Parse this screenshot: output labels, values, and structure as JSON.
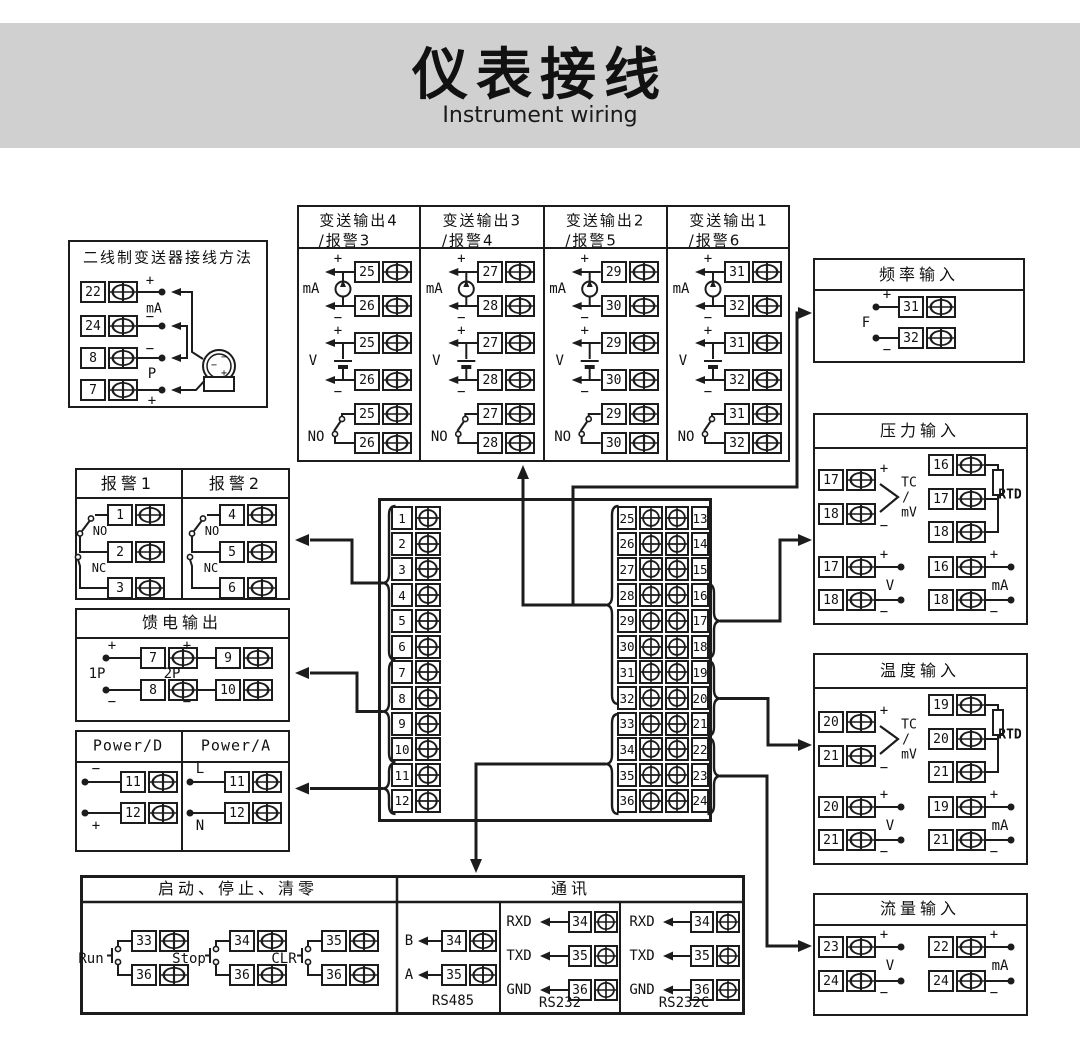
{
  "title": {
    "zh": "仪表接线",
    "en": "Instrument wiring"
  },
  "signs": {
    "plus": "+",
    "minus": "−"
  },
  "two_wire": {
    "title": "二线制变送器接线方法",
    "terminals": [
      "22",
      "24",
      "8",
      "7"
    ],
    "labels": {
      "ma": "mA",
      "p": "P"
    },
    "sensor": {
      "minus1": "−",
      "minus2": "−",
      "plus": "+"
    }
  },
  "transmit": {
    "columns": [
      {
        "title": "变送输出4",
        "subtitle": "/报警3",
        "pair": [
          "25",
          "26"
        ]
      },
      {
        "title": "变送输出3",
        "subtitle": "/报警4",
        "pair": [
          "27",
          "28"
        ]
      },
      {
        "title": "变送输出2",
        "subtitle": "/报警5",
        "pair": [
          "29",
          "30"
        ]
      },
      {
        "title": "变送输出1",
        "subtitle": "/报警6",
        "pair": [
          "31",
          "32"
        ]
      }
    ],
    "labels": {
      "ma": "mA",
      "v": "V",
      "no": "NO"
    }
  },
  "frequency": {
    "title": "频率输入",
    "label": "F",
    "terminals": [
      {
        "n": "31"
      },
      {
        "n": "32"
      }
    ]
  },
  "pressure": {
    "title": "压力输入",
    "tc": {
      "terminals": [
        "17",
        "18"
      ],
      "lines": [
        "TC",
        "/",
        "mV"
      ]
    },
    "rtd": {
      "terminals": [
        "16",
        "17",
        "18"
      ],
      "label": "RTD"
    },
    "v": {
      "terminals": [
        "17",
        "18"
      ],
      "label": "V"
    },
    "ma": {
      "terminals": [
        "16",
        "18"
      ],
      "label": "mA"
    }
  },
  "temperature": {
    "title": "温度输入",
    "tc": {
      "terminals": [
        "20",
        "21"
      ],
      "lines": [
        "TC",
        "/",
        "mV"
      ]
    },
    "rtd": {
      "terminals": [
        "19",
        "20",
        "21"
      ],
      "label": "RTD"
    },
    "v": {
      "terminals": [
        "20",
        "21"
      ],
      "label": "V"
    },
    "ma": {
      "terminals": [
        "19",
        "21"
      ],
      "label": "mA"
    }
  },
  "flow": {
    "title": "流量输入",
    "v": {
      "terminals": [
        "23",
        "24"
      ],
      "label": "V"
    },
    "ma": {
      "terminals": [
        "22",
        "24"
      ],
      "label": "mA"
    }
  },
  "alarm": {
    "columns": [
      {
        "title": "报警1",
        "terminals": [
          "1",
          "2",
          "3"
        ]
      },
      {
        "title": "报警2",
        "terminals": [
          "4",
          "5",
          "6"
        ]
      }
    ],
    "labels": {
      "no": "NO",
      "nc": "NC"
    }
  },
  "feed": {
    "title": "馈电输出",
    "groups": [
      {
        "label": "1P",
        "terminals": [
          "7",
          "8"
        ]
      },
      {
        "label": "2P",
        "terminals": [
          "9",
          "10"
        ]
      }
    ]
  },
  "power": {
    "columns": [
      {
        "title": "Power/D",
        "top": "−",
        "bottom": "+",
        "terminals": [
          "11",
          "12"
        ]
      },
      {
        "title": "Power/A",
        "top": "L",
        "bottom": "N",
        "terminals": [
          "11",
          "12"
        ]
      }
    ]
  },
  "control": {
    "title": "启动、停止、清零",
    "groups": [
      {
        "label": "Run",
        "terminals": [
          "33",
          "36"
        ]
      },
      {
        "label": "Stop",
        "terminals": [
          "34",
          "36"
        ]
      },
      {
        "label": "CLR",
        "terminals": [
          "35",
          "36"
        ]
      }
    ]
  },
  "comm": {
    "title": "通讯",
    "sections": [
      {
        "name": "RS485",
        "rows": [
          {
            "label": "B",
            "terminal": "34"
          },
          {
            "label": "A",
            "terminal": "35"
          }
        ]
      },
      {
        "name": "RS232",
        "rows": [
          {
            "label": "RXD",
            "terminal": "34"
          },
          {
            "label": "TXD",
            "terminal": "35"
          },
          {
            "label": "GND",
            "terminal": "36"
          }
        ]
      },
      {
        "name": "RS232C",
        "rows": [
          {
            "label": "RXD",
            "terminal": "34"
          },
          {
            "label": "TXD",
            "terminal": "35"
          },
          {
            "label": "GND",
            "terminal": "36"
          }
        ]
      }
    ]
  },
  "center_block": {
    "left": [
      "1",
      "2",
      "3",
      "4",
      "5",
      "6",
      "7",
      "8",
      "9",
      "10",
      "11",
      "12"
    ],
    "rows": [
      {
        "l": "25",
        "r": "13"
      },
      {
        "l": "26",
        "r": "14"
      },
      {
        "l": "27",
        "r": "15"
      },
      {
        "l": "28",
        "r": "16"
      },
      {
        "l": "29",
        "r": "17"
      },
      {
        "l": "30",
        "r": "18"
      },
      {
        "l": "31",
        "r": "19"
      },
      {
        "l": "32",
        "r": "20"
      },
      {
        "l": "33",
        "r": "21"
      },
      {
        "l": "34",
        "r": "22"
      },
      {
        "l": "35",
        "r": "23"
      },
      {
        "l": "36",
        "r": "24"
      }
    ]
  },
  "colors": {
    "line": "#1c1c1c",
    "band": "#d0d0d0",
    "background": "#ffffff"
  }
}
